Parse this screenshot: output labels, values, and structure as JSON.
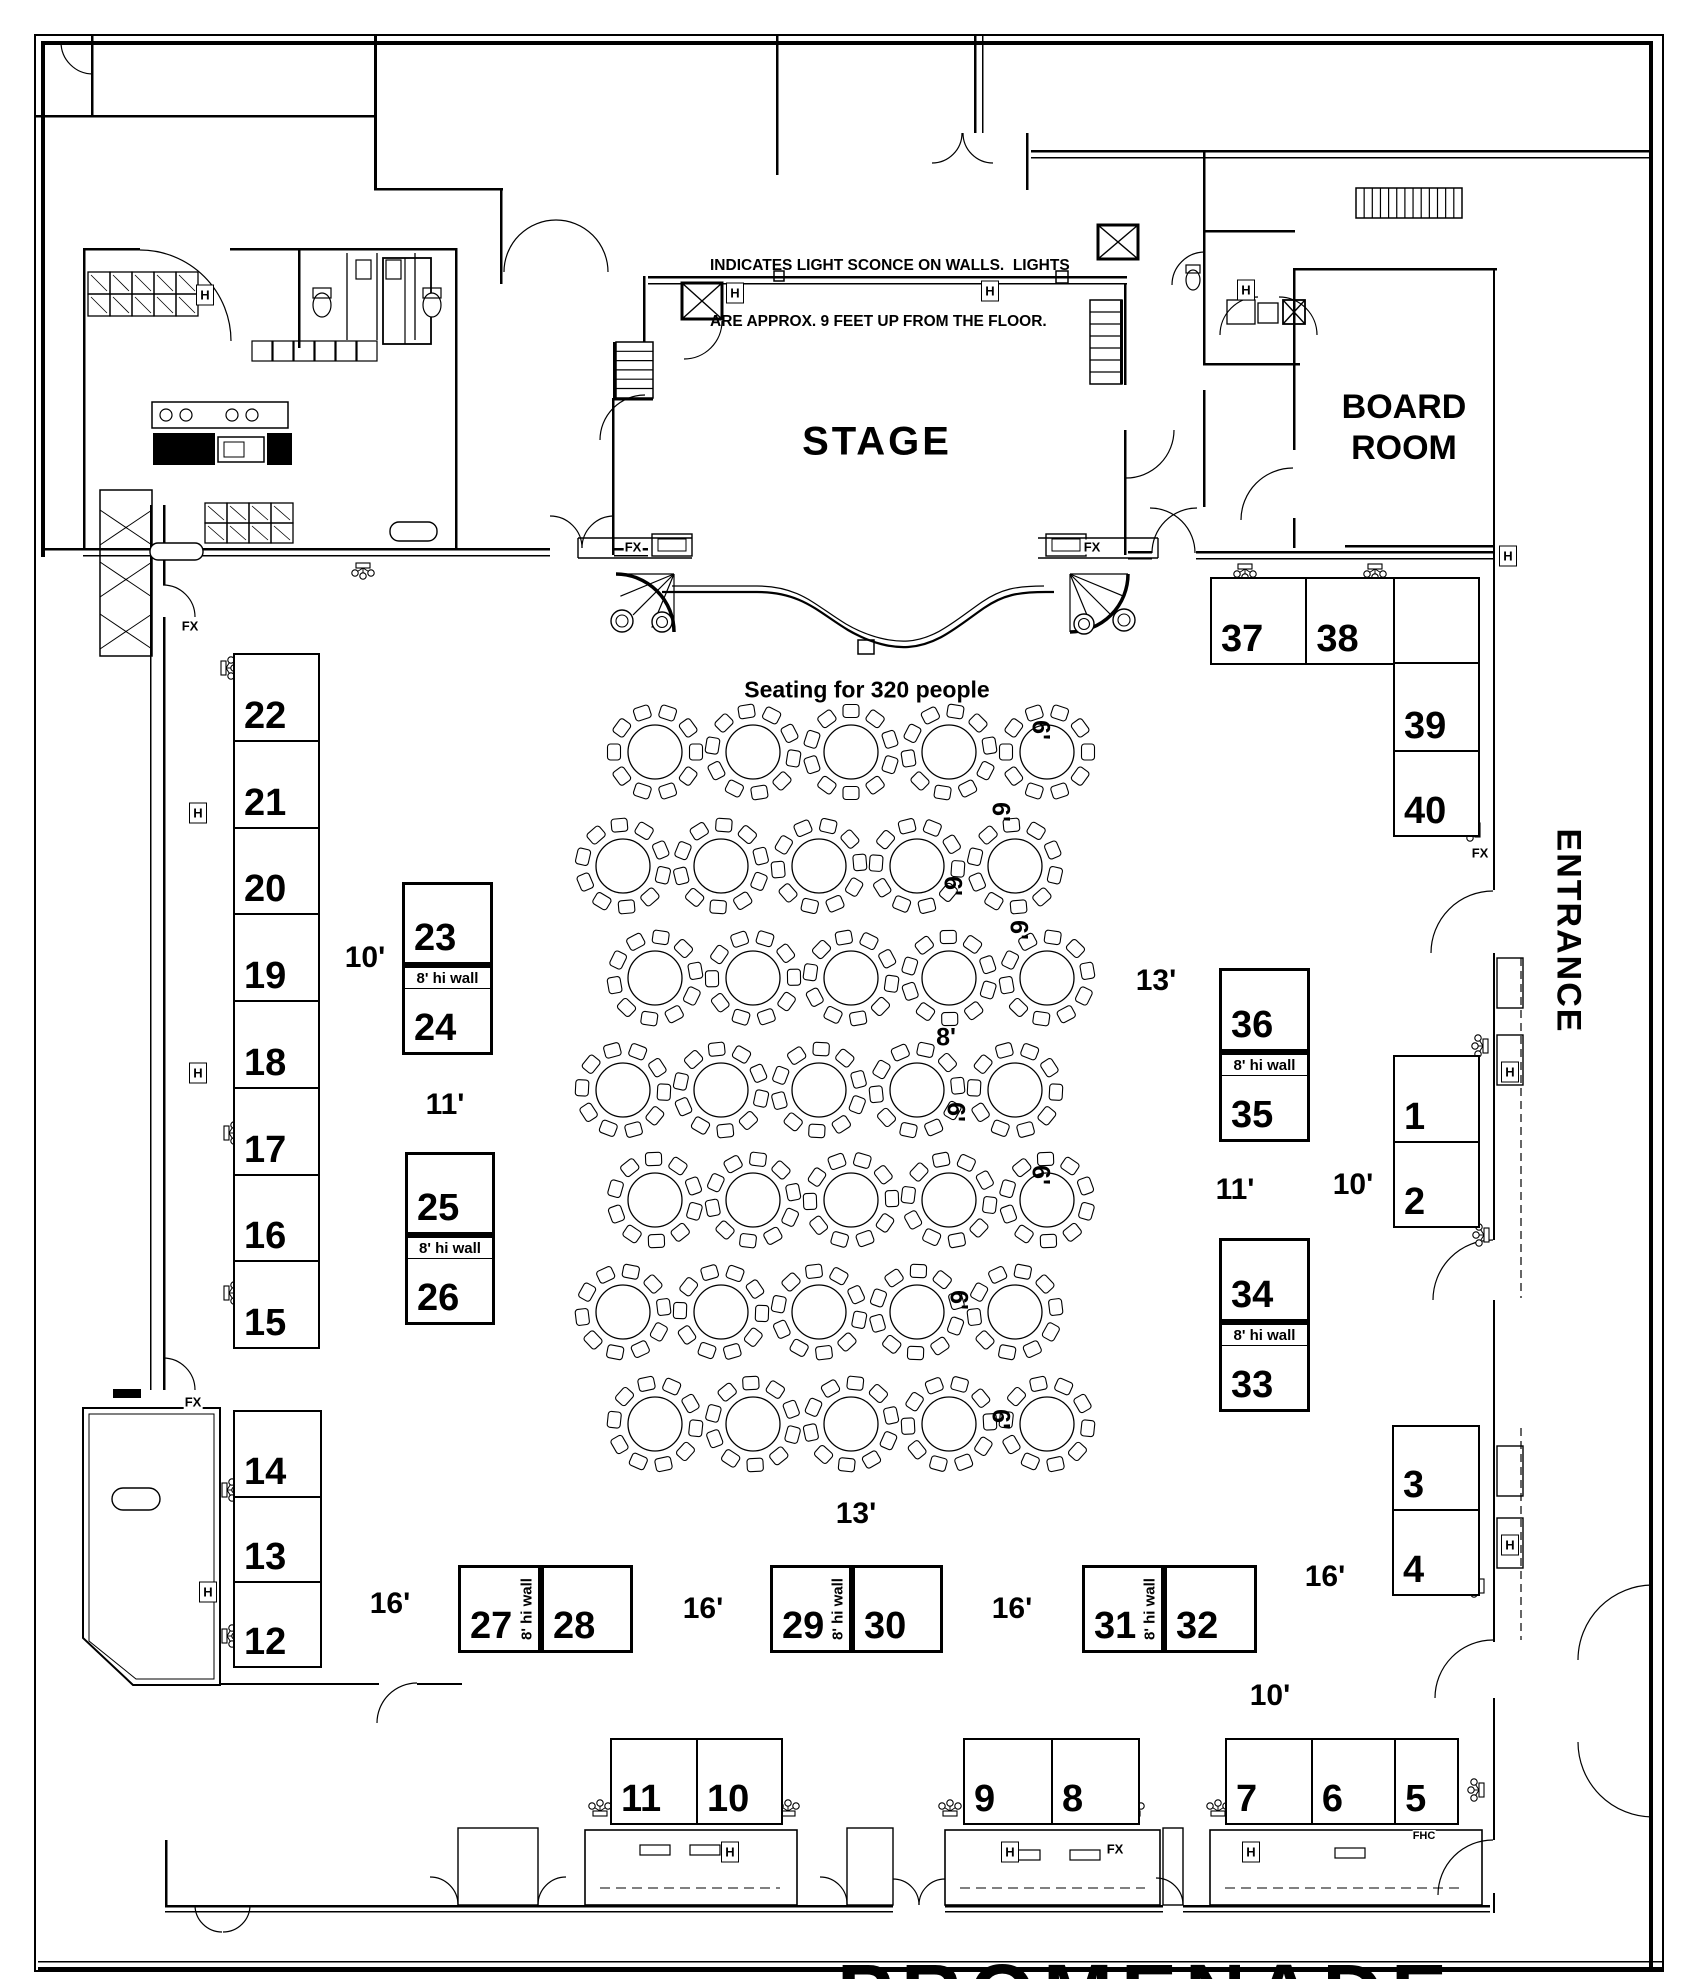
{
  "legend": {
    "line1": "INDICATES LIGHT SCONCE ON WALLS.  LIGHTS",
    "line2": "ARE APPROX. 9 FEET UP FROM THE FLOOR."
  },
  "rooms": {
    "stage": "STAGE",
    "board_room_line1": "BOARD",
    "board_room_line2": "ROOM",
    "entrance": "ENTRANCE",
    "promenade": "PROMENADE"
  },
  "seating_note": "Seating for 320 people",
  "hiwall_label": "8' hi wall",
  "booth_groups": [
    {
      "type": "v",
      "x": 233,
      "y": 653,
      "w": 87,
      "h": 696,
      "cells": [
        {
          "label": "22",
          "s": 87
        },
        {
          "label": "21",
          "s": 87
        },
        {
          "label": "20",
          "s": 87
        },
        {
          "label": "19",
          "s": 87
        },
        {
          "label": "18",
          "s": 87
        },
        {
          "label": "17",
          "s": 87
        },
        {
          "label": "16",
          "s": 87
        },
        {
          "label": "15",
          "s": 87
        }
      ]
    },
    {
      "type": "v",
      "x": 233,
      "y": 1410,
      "w": 89,
      "h": 258,
      "cells": [
        {
          "label": "14",
          "s": 87
        },
        {
          "label": "13",
          "s": 85
        },
        {
          "label": "12",
          "s": 86
        }
      ]
    },
    {
      "type": "h",
      "x": 1210,
      "y": 577,
      "w": 185,
      "h": 88,
      "cells": [
        {
          "label": "37",
          "s": 97
        },
        {
          "label": "38",
          "s": 88
        }
      ]
    },
    {
      "type": "v",
      "x": 1393,
      "y": 577,
      "w": 87,
      "h": 260,
      "cells": [
        {
          "label": "",
          "s": 86
        },
        {
          "label": "39",
          "s": 88
        },
        {
          "label": "40",
          "s": 86
        }
      ]
    },
    {
      "type": "v",
      "x": 1393,
      "y": 1055,
      "w": 87,
      "h": 173,
      "cells": [
        {
          "label": "1",
          "s": 87
        },
        {
          "label": "2",
          "s": 86
        }
      ]
    },
    {
      "type": "v",
      "x": 1392,
      "y": 1425,
      "w": 88,
      "h": 171,
      "cells": [
        {
          "label": "3",
          "s": 85
        },
        {
          "label": "4",
          "s": 86
        }
      ]
    },
    {
      "type": "h",
      "x": 610,
      "y": 1738,
      "w": 173,
      "h": 87,
      "cells": [
        {
          "label": "11",
          "s": 87
        },
        {
          "label": "10",
          "s": 86
        }
      ]
    },
    {
      "type": "h",
      "x": 963,
      "y": 1738,
      "w": 177,
      "h": 87,
      "cells": [
        {
          "label": "9",
          "s": 89
        },
        {
          "label": "8",
          "s": 88
        }
      ]
    },
    {
      "type": "h",
      "x": 1225,
      "y": 1738,
      "w": 234,
      "h": 87,
      "cells": [
        {
          "label": "7",
          "s": 88
        },
        {
          "label": "6",
          "s": 85
        },
        {
          "label": "5",
          "s": 61
        }
      ]
    }
  ],
  "hiwall_booths": [
    {
      "dir": "v",
      "x": 402,
      "y": 882,
      "w": 91,
      "h": 173,
      "first": "23",
      "second": "24",
      "second_size": 58
    },
    {
      "dir": "v",
      "x": 405,
      "y": 1152,
      "w": 90,
      "h": 173,
      "first": "25",
      "second": "26",
      "second_size": 58
    },
    {
      "dir": "v",
      "x": 1219,
      "y": 968,
      "w": 91,
      "h": 174,
      "first": "36",
      "second": "35",
      "second_size": 58
    },
    {
      "dir": "v",
      "x": 1219,
      "y": 1238,
      "w": 91,
      "h": 174,
      "first": "34",
      "second": "33",
      "second_size": 58
    },
    {
      "dir": "h",
      "x": 458,
      "y": 1565,
      "w": 175,
      "h": 88,
      "first": "27",
      "second": "28",
      "second_size": 77
    },
    {
      "dir": "h",
      "x": 770,
      "y": 1565,
      "w": 173,
      "h": 88,
      "first": "29",
      "second": "30",
      "second_size": 76
    },
    {
      "dir": "h",
      "x": 1082,
      "y": 1565,
      "w": 175,
      "h": 88,
      "first": "31",
      "second": "32",
      "second_size": 78
    }
  ],
  "dimension_labels": [
    {
      "t": "10'",
      "x": 365,
      "y": 958
    },
    {
      "t": "11'",
      "x": 445,
      "y": 1105
    },
    {
      "t": "13'",
      "x": 1156,
      "y": 981
    },
    {
      "t": "11'",
      "x": 1235,
      "y": 1190
    },
    {
      "t": "10'",
      "x": 1353,
      "y": 1185
    },
    {
      "t": "13'",
      "x": 856,
      "y": 1514
    },
    {
      "t": "16'",
      "x": 390,
      "y": 1604
    },
    {
      "t": "16'",
      "x": 703,
      "y": 1609
    },
    {
      "t": "16'",
      "x": 1012,
      "y": 1609
    },
    {
      "t": "16'",
      "x": 1325,
      "y": 1577
    },
    {
      "t": "10'",
      "x": 1270,
      "y": 1696
    }
  ],
  "size_labels": [
    {
      "t": "6'",
      "x": 1040,
      "y": 730,
      "rot": 90
    },
    {
      "t": "6'",
      "x": 1000,
      "y": 812,
      "rot": 90
    },
    {
      "t": "6'",
      "x": 952,
      "y": 886,
      "rot": 90
    },
    {
      "t": "6'",
      "x": 1018,
      "y": 930,
      "rot": 90
    },
    {
      "t": "8'",
      "x": 946,
      "y": 1038,
      "rot": 0
    },
    {
      "t": "6'",
      "x": 955,
      "y": 1112,
      "rot": 90
    },
    {
      "t": "6'",
      "x": 1040,
      "y": 1175,
      "rot": 90
    },
    {
      "t": "6'",
      "x": 958,
      "y": 1300,
      "rot": 90
    },
    {
      "t": "6'",
      "x": 1000,
      "y": 1419,
      "rot": 90
    }
  ],
  "wall_markers": {
    "fx_label": "FX",
    "fx": [
      [
        633,
        547
      ],
      [
        1092,
        547
      ],
      [
        190,
        626
      ],
      [
        193,
        1402
      ],
      [
        1480,
        853
      ],
      [
        1115,
        1849
      ]
    ],
    "h_label": "H",
    "h": [
      [
        205,
        295
      ],
      [
        735,
        293
      ],
      [
        990,
        291
      ],
      [
        1246,
        290
      ],
      [
        1508,
        556
      ],
      [
        198,
        813
      ],
      [
        198,
        1073
      ],
      [
        1510,
        1072
      ],
      [
        208,
        1592
      ],
      [
        730,
        1852
      ],
      [
        1010,
        1852
      ],
      [
        1251,
        1852
      ],
      [
        1510,
        1545
      ]
    ],
    "fhc_label": "FHC",
    "fhc": [
      [
        1424,
        1836
      ]
    ]
  },
  "sconces": [
    [
      363,
      567,
      0
    ],
    [
      1245,
      568,
      0
    ],
    [
      1375,
      568,
      0
    ],
    [
      225,
      668,
      -90
    ],
    [
      228,
      1133,
      -90
    ],
    [
      228,
      1293,
      -90
    ],
    [
      226,
      1490,
      -90
    ],
    [
      226,
      1636,
      -90
    ],
    [
      1476,
      830,
      90
    ],
    [
      1484,
      1046,
      90
    ],
    [
      1485,
      1235,
      90
    ],
    [
      1480,
      1586,
      90
    ],
    [
      1480,
      1790,
      90
    ],
    [
      600,
      1812,
      180
    ],
    [
      788,
      1812,
      180
    ],
    [
      950,
      1812,
      180
    ],
    [
      1133,
      1812,
      180
    ],
    [
      1218,
      1812,
      180
    ]
  ],
  "symbols": {
    "sconce": "wall-light-sconce",
    "h": "door-hardware-marker",
    "fx": "fire-extinguisher-marker",
    "fhc": "fire-hose-cabinet-marker"
  },
  "table_grid": {
    "rows": [
      {
        "y": 752,
        "x0": 655
      },
      {
        "y": 866,
        "x0": 623
      },
      {
        "y": 978,
        "x0": 655
      },
      {
        "y": 1090,
        "x0": 623
      },
      {
        "y": 1200,
        "x0": 655
      },
      {
        "y": 1312,
        "x0": 623
      },
      {
        "y": 1424,
        "x0": 655
      }
    ],
    "cols": 5,
    "spacing": 98,
    "table_radius": 27,
    "chairs_per_table": 10
  },
  "colors": {
    "ink": "#000000",
    "paper": "#ffffff"
  }
}
